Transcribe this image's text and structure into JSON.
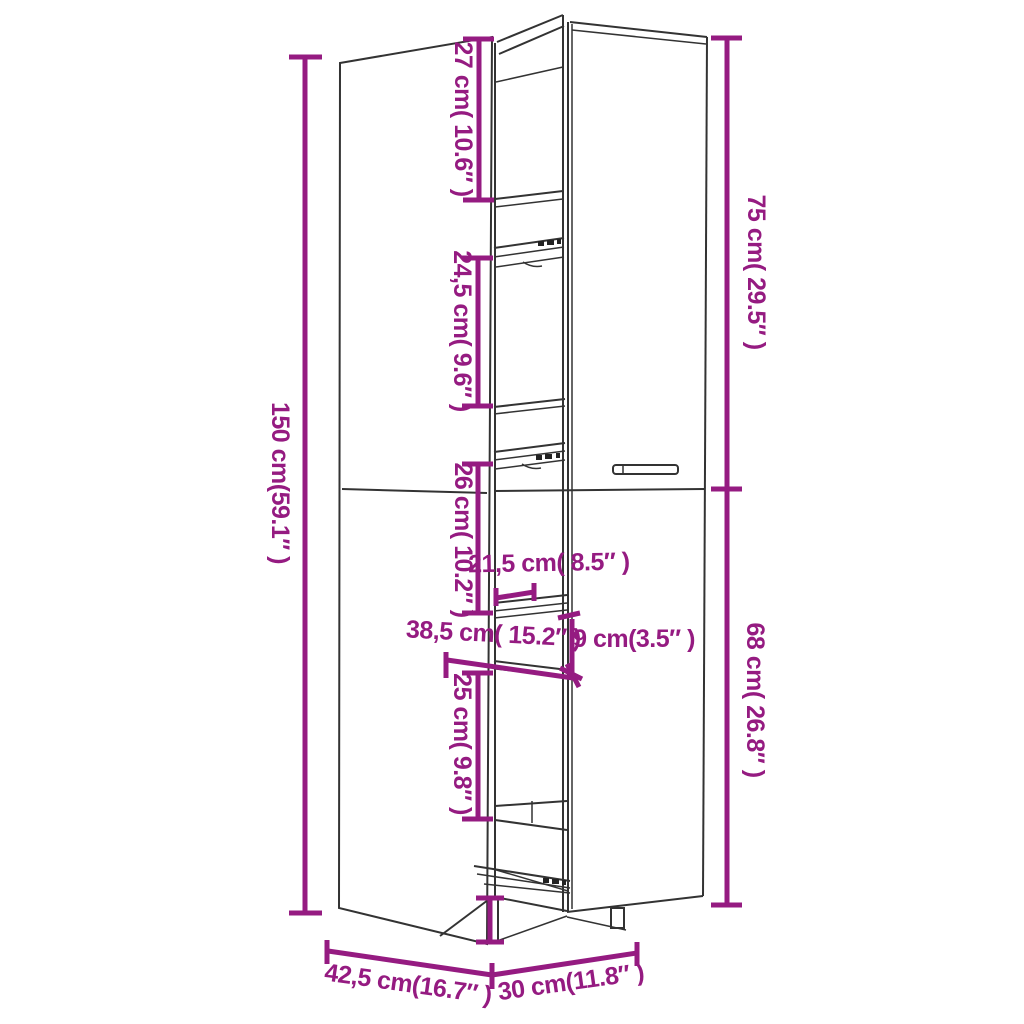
{
  "diagram_title": "Tall cabinet dimension drawing",
  "colors": {
    "dimension_accent": "#951B81",
    "drawing_line": "#333333",
    "background": "#FFFFFF"
  },
  "dimensions": [
    {
      "id": "total-height",
      "label": "150 cm(59.1″ )"
    },
    {
      "id": "top-compartment-height",
      "label": "27 cm( 10.6″ )"
    },
    {
      "id": "second-compartment-height",
      "label": "24,5 cm( 9.6″ )"
    },
    {
      "id": "third-compartment-height",
      "label": "26 cm( 10.2″ )"
    },
    {
      "id": "drawer-width",
      "label": "21,5 cm( 8.5″ )"
    },
    {
      "id": "drawer-depth",
      "label": "38,5 cm( 15.2″ )"
    },
    {
      "id": "drawer-height",
      "label": "9 cm(3.5″ )"
    },
    {
      "id": "fourth-compartment-height",
      "label": "25 cm( 9.8″ )"
    },
    {
      "id": "upper-door-height",
      "label": "75 cm( 29.5″ )"
    },
    {
      "id": "lower-door-height",
      "label": "68 cm( 26.8″ )"
    },
    {
      "id": "cabinet-depth",
      "label": "42,5 cm(16.7″ )"
    },
    {
      "id": "cabinet-width",
      "label": "30 cm(11.8″ )"
    }
  ]
}
